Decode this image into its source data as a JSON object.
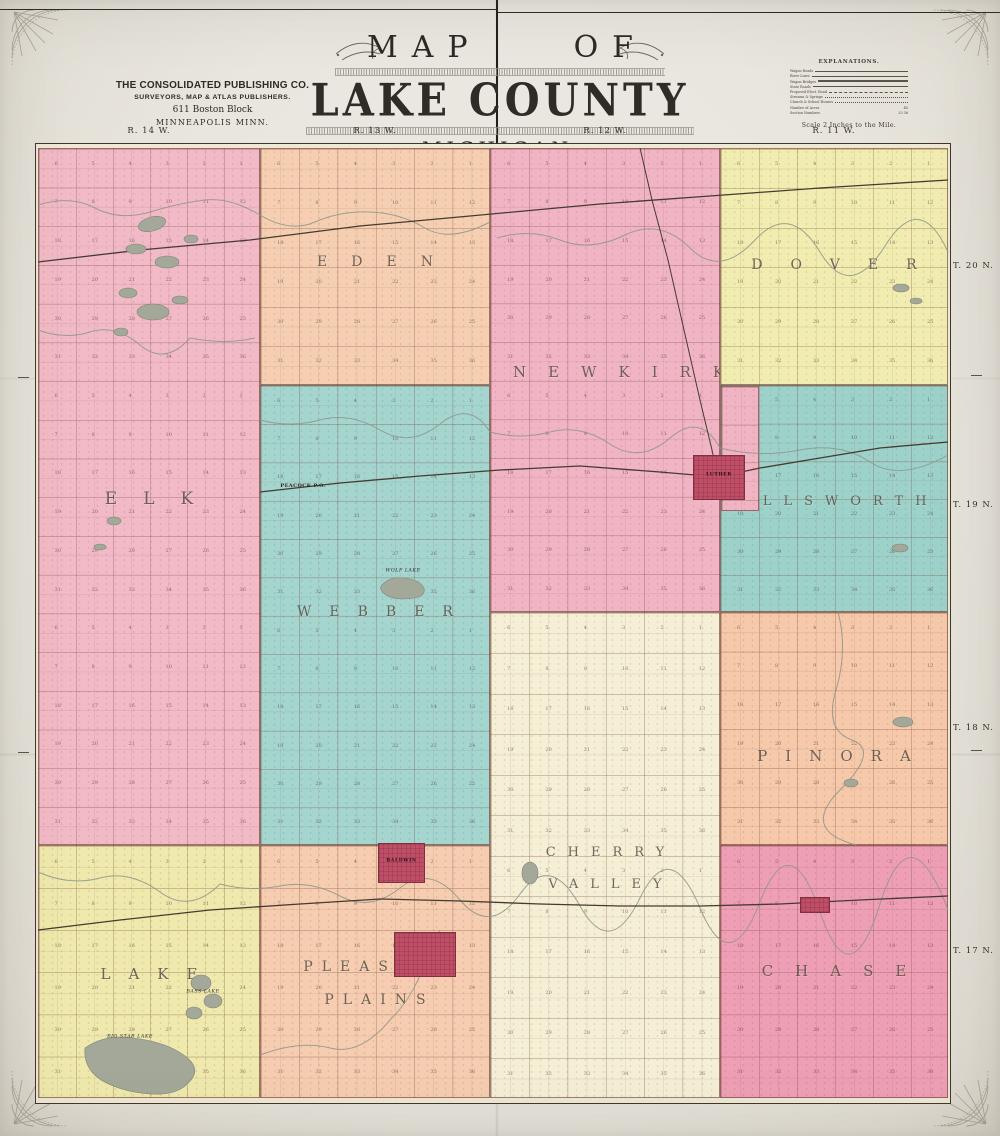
{
  "publisher": {
    "line1": "THE CONSOLIDATED PUBLISHING CO.",
    "line2": "SURVEYORS, MAP & ATLAS PUBLISHERS.",
    "line3": "611 Boston Block",
    "line4": "MINNEAPOLIS MINN."
  },
  "title": {
    "word1": "MAP",
    "word2": "OF",
    "county": "LAKE COUNTY",
    "state": "MICHIGAN.",
    "year": "1900"
  },
  "explanations": {
    "heading": "EXPLANATIONS.",
    "rows": [
      {
        "label": "Wagon Roads",
        "line": "solid"
      },
      {
        "label": "River Lines",
        "line": "solid"
      },
      {
        "label": "Wagon Bridges",
        "line": "double"
      },
      {
        "label": "State Roads",
        "line": "solid"
      },
      {
        "label": "Proposed Elect. Road",
        "line": "dashed"
      },
      {
        "label": "Streams & Springs",
        "line": "dotted"
      },
      {
        "label": "Church & School Houses",
        "line": "dotted"
      },
      {
        "label": "Number of Acres",
        "sample": "40"
      },
      {
        "label": "Section Numbers",
        "sample": "25  36"
      }
    ],
    "scale_note": "Scale 2 Inches to the Mile."
  },
  "margins": {
    "range_labels": [
      {
        "label": "R. 14 W.",
        "x": 149
      },
      {
        "label": "R. 13 W.",
        "x": 375
      },
      {
        "label": "R. 12 W.",
        "x": 605
      },
      {
        "label": "R. 11 W.",
        "x": 834
      }
    ],
    "row_labels": [
      {
        "label": "T. 20 N.",
        "y": 261
      },
      {
        "label": "T. 19 N.",
        "y": 500
      },
      {
        "label": "T. 18 N.",
        "y": 723
      },
      {
        "label": "T. 17 N.",
        "y": 946
      }
    ]
  },
  "townships": [
    {
      "id": "elk",
      "lines": [
        "ELK"
      ],
      "color": "#f2bac7",
      "x": 38,
      "y": 148,
      "w": 222,
      "h": 697,
      "ly": 480,
      "fs": 17,
      "ls": 26,
      "lh": 36
    },
    {
      "id": "eden",
      "lines": [
        "EDEN"
      ],
      "color": "#f6cfb2",
      "x": 260,
      "y": 148,
      "w": 230,
      "h": 237,
      "ly": 246,
      "fs": 14,
      "ls": 24,
      "lh": 30
    },
    {
      "id": "newkirk",
      "lines": [
        "NEWKIRK"
      ],
      "color": "#f1b4c4",
      "x": 490,
      "y": 148,
      "w": 230,
      "h": 464,
      "ly": 356,
      "fs": 15,
      "ls": 22,
      "lh": 30
    },
    {
      "id": "dover",
      "lines": [
        "DOVER"
      ],
      "color": "#f1ecb0",
      "x": 720,
      "y": 148,
      "w": 228,
      "h": 237,
      "ly": 249,
      "fs": 14,
      "ls": 28,
      "lh": 30
    },
    {
      "id": "webber",
      "lines": [
        "WEBBER"
      ],
      "color": "#a4d5cf",
      "x": 260,
      "y": 385,
      "w": 230,
      "h": 460,
      "ly": 596,
      "fs": 14,
      "ls": 18,
      "lh": 30
    },
    {
      "id": "ellsworth",
      "lines": [
        "ELLSWORTH"
      ],
      "color": "#9dd2cb",
      "x": 720,
      "y": 385,
      "w": 228,
      "h": 227,
      "ly": 487,
      "fs": 13,
      "ls": 12,
      "lh": 28
    },
    {
      "id": "pinora",
      "lines": [
        "PINORA"
      ],
      "color": "#f5c9a9",
      "x": 720,
      "y": 612,
      "w": 228,
      "h": 233,
      "ly": 740,
      "fs": 15,
      "ls": 18,
      "lh": 30
    },
    {
      "id": "cherry-valley",
      "lines": [
        "CHERRY",
        "VALLEY"
      ],
      "color": "#f4efd5",
      "x": 490,
      "y": 612,
      "w": 230,
      "h": 486,
      "ly": 836,
      "fs": 13,
      "ls": 12,
      "lh": 32
    },
    {
      "id": "lake",
      "lines": [
        "LAKE"
      ],
      "color": "#efe9ad",
      "x": 38,
      "y": 845,
      "w": 222,
      "h": 253,
      "ly": 958,
      "fs": 15,
      "ls": 18,
      "lh": 30
    },
    {
      "id": "pleasant-plains",
      "lines": [
        "PLEASANT",
        "PLAINS"
      ],
      "color": "#f6cdb0",
      "x": 260,
      "y": 845,
      "w": 230,
      "h": 253,
      "ly": 950,
      "fs": 14,
      "ls": 9,
      "lh": 33
    },
    {
      "id": "chase",
      "lines": [
        "CHASE"
      ],
      "color": "#ee9fb5",
      "x": 720,
      "y": 845,
      "w": 228,
      "h": 253,
      "ly": 955,
      "fs": 15,
      "ls": 22,
      "lh": 30
    }
  ],
  "patches": [
    {
      "id": "luther-corner",
      "color": "#f1b4c4",
      "x": 721,
      "y": 386,
      "w": 38,
      "h": 125
    }
  ],
  "villages": [
    {
      "id": "luther",
      "label": "LUTHER",
      "x": 693,
      "y": 455,
      "w": 52,
      "h": 45
    },
    {
      "id": "baldwin",
      "label": "BALDWIN",
      "x": 378,
      "y": 843,
      "w": 47,
      "h": 40
    },
    {
      "id": "baldwin-addition",
      "label": "",
      "x": 394,
      "y": 932,
      "w": 62,
      "h": 45
    },
    {
      "id": "chase-village",
      "label": "",
      "x": 800,
      "y": 897,
      "w": 30,
      "h": 16
    }
  ],
  "places": [
    {
      "label": "PEACOCK P.O.",
      "x": 303,
      "y": 486
    }
  ],
  "lakes": [
    {
      "label": "WOLF LAKE",
      "x": 403,
      "y": 571
    },
    {
      "label": "BASS LAKE",
      "x": 203,
      "y": 992
    },
    {
      "label": "BIG STAR LAKE",
      "x": 130,
      "y": 1037
    }
  ],
  "colors": {
    "paper": "#eae7e0",
    "map_base": "#efe8d5",
    "village_red": "#bf4e66",
    "water_gray": "#a3a899",
    "frame_line": "#42362a"
  }
}
